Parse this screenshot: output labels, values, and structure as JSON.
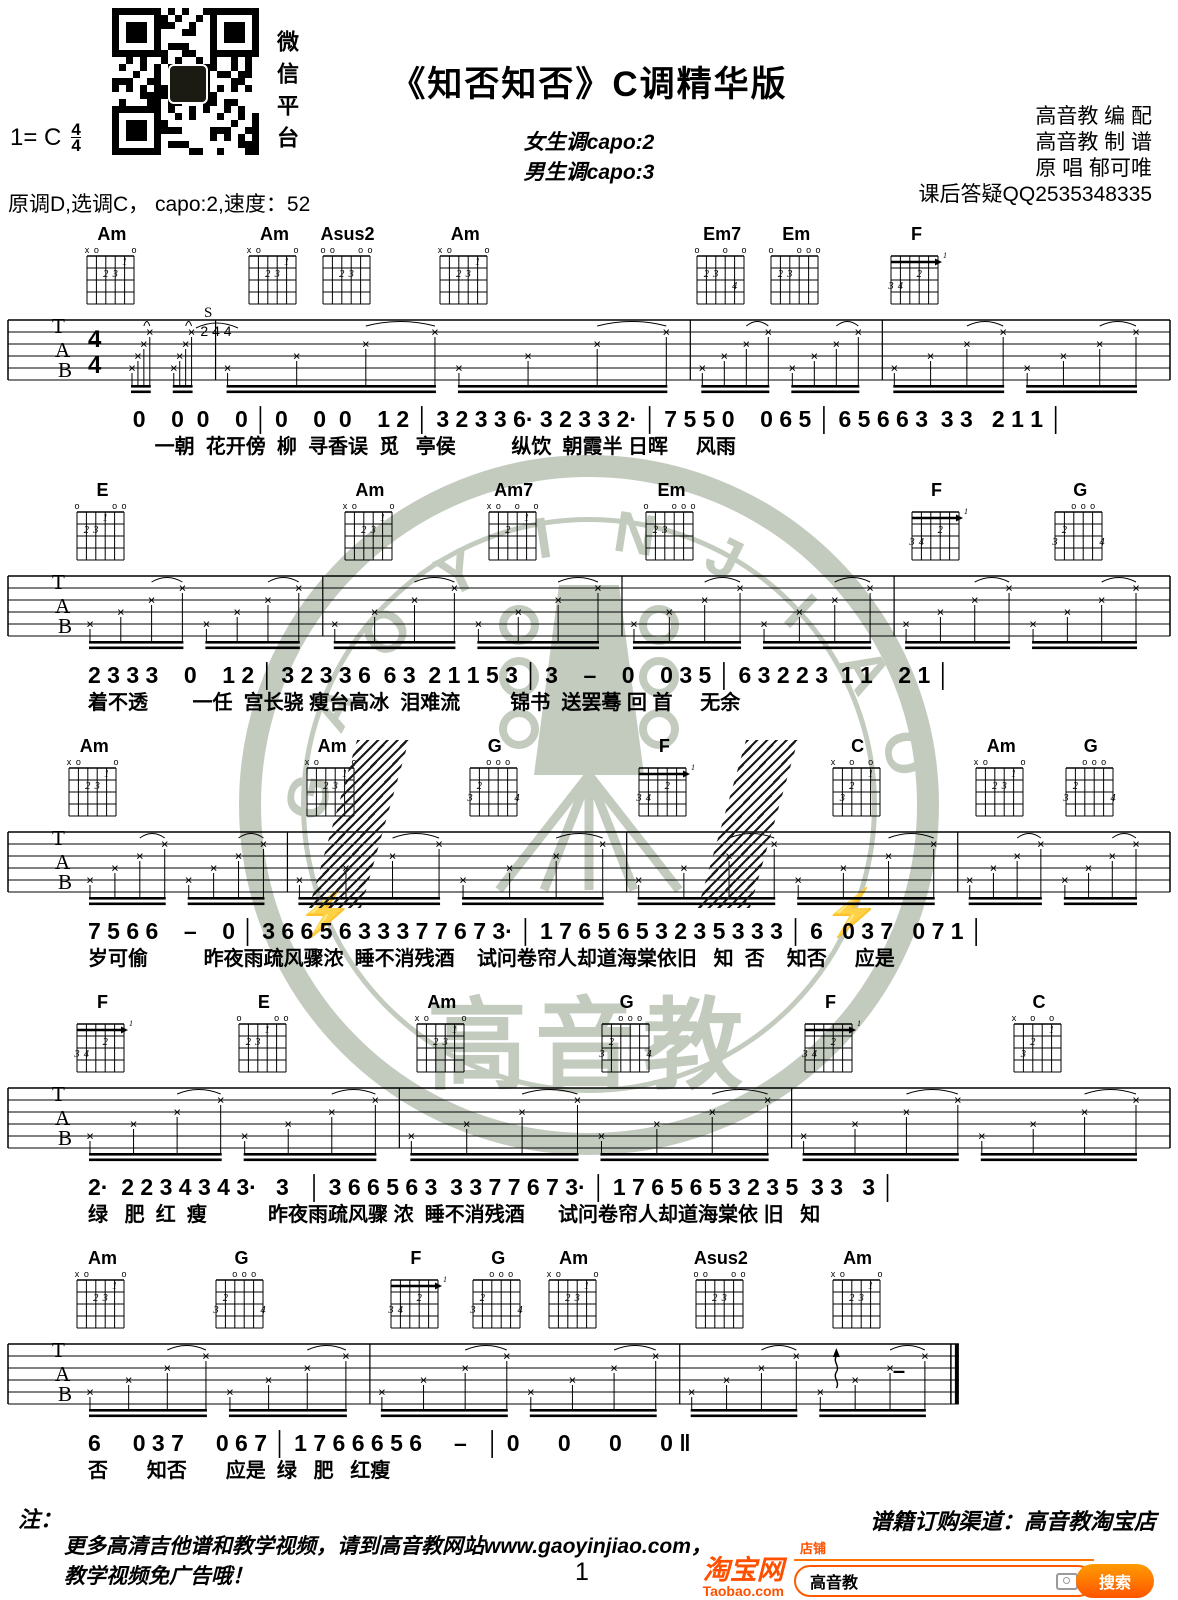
{
  "header": {
    "title": "《知否知否》C调精华版",
    "capo_female": "女生调capo:2",
    "capo_male": "男生调capo:3",
    "key": "1= C",
    "ts_top": "4",
    "ts_bottom": "4",
    "tempo_line": "原调D,选调C， capo:2,速度：52",
    "qr_caption": "微信平台",
    "credits": [
      "高音教 编  配",
      "高音教 制  谱",
      "原  唱  郁可唯",
      "课后答疑QQ2535348335"
    ]
  },
  "staff_letters": [
    "T",
    "A",
    "B"
  ],
  "chord_shapes": {
    "Am": {
      "markers": [
        "x",
        "o",
        "",
        "",
        "",
        "o"
      ],
      "dots": [
        [
          1,
          5,
          "1"
        ],
        [
          2,
          3,
          "2"
        ],
        [
          2,
          4,
          "3"
        ]
      ]
    },
    "Asus2": {
      "markers": [
        "o",
        "o",
        "",
        "",
        "o",
        "o"
      ],
      "dots": [
        [
          2,
          3,
          "2"
        ],
        [
          2,
          4,
          "3"
        ]
      ]
    },
    "Em7": {
      "markers": [
        "o",
        "",
        "",
        "o",
        "",
        "o"
      ],
      "dots": [
        [
          2,
          2,
          "2"
        ],
        [
          2,
          3,
          "3"
        ],
        [
          3,
          5,
          "4"
        ]
      ]
    },
    "Em": {
      "markers": [
        "o",
        "",
        "",
        "o",
        "o",
        "o"
      ],
      "dots": [
        [
          2,
          2,
          "2"
        ],
        [
          2,
          3,
          "3"
        ]
      ]
    },
    "F": {
      "markers": [
        "",
        "",
        "",
        "",
        "",
        ""
      ],
      "barre": {
        "fret": 1,
        "label": "1"
      },
      "dots": [
        [
          2,
          4,
          "2"
        ],
        [
          3,
          1,
          "3"
        ],
        [
          3,
          2,
          "4"
        ]
      ]
    },
    "E": {
      "markers": [
        "o",
        "",
        "",
        "",
        "o",
        "o"
      ],
      "dots": [
        [
          1,
          4,
          "1"
        ],
        [
          2,
          2,
          "2"
        ],
        [
          2,
          3,
          "3"
        ]
      ]
    },
    "Am7": {
      "markers": [
        "x",
        "o",
        "",
        "o",
        "",
        "o"
      ],
      "dots": [
        [
          1,
          5,
          "1"
        ],
        [
          2,
          3,
          "2"
        ]
      ]
    },
    "G": {
      "markers": [
        "",
        "",
        "o",
        "o",
        "o",
        ""
      ],
      "dots": [
        [
          2,
          2,
          "2"
        ],
        [
          3,
          1,
          "3"
        ],
        [
          3,
          6,
          "4"
        ]
      ]
    },
    "C": {
      "markers": [
        "x",
        "",
        "o",
        "",
        "o",
        ""
      ],
      "dots": [
        [
          1,
          5,
          "1"
        ],
        [
          2,
          3,
          "2"
        ],
        [
          3,
          2,
          "3"
        ]
      ]
    }
  },
  "systems": [
    {
      "chords": [
        {
          "name": "Am",
          "x": 9.5
        },
        {
          "name": "Am",
          "x": 23.3
        },
        {
          "name": "Asus2",
          "x": 29.5
        },
        {
          "name": "Am",
          "x": 39.5
        },
        {
          "name": "Em7",
          "x": 61.3
        },
        {
          "name": "Em",
          "x": 67.6
        },
        {
          "name": "F",
          "x": 77.8
        }
      ],
      "barlines": [
        18.3,
        58.6,
        74.9
      ],
      "show_time_sig": true,
      "annotation": "S",
      "annotation_nums": "2 4 4",
      "melody": "       0    0  0    0 │ 0    0  0    1 2 │ 3 2 3 3 6· 3 2 3 3 2· │ 7 5 5 0    0 6 5 │ 6 5 6 6 3  3 3   2 1 1 │",
      "lyrics": "            一朝  花开傍  柳  寻香误  觅   亭侯          纵饮  朝霞半 日晖     风雨"
    },
    {
      "chords": [
        {
          "name": "E",
          "x": 8.7
        },
        {
          "name": "Am",
          "x": 31.4
        },
        {
          "name": "Am7",
          "x": 43.6
        },
        {
          "name": "Em",
          "x": 57.0
        },
        {
          "name": "F",
          "x": 79.5
        },
        {
          "name": "G",
          "x": 91.7
        }
      ],
      "barlines": [
        27.4,
        52.8,
        75.9
      ],
      "melody": "2 3 3 3    0    1 2 │ 3 2 3 3 6  6 3  2 1 1 5 3 │ 3    –    0    0 3 5 │ 6 3 2 2 3  1 1    2 1 │",
      "lyrics": "着不透        一任  宫长骁 瘦台高冰  泪难流         锦书  送罢蓦 回 首     无余"
    },
    {
      "chords": [
        {
          "name": "Am",
          "x": 8.0
        },
        {
          "name": "Am",
          "x": 28.2
        },
        {
          "name": "G",
          "x": 42.0
        },
        {
          "name": "F",
          "x": 56.4
        },
        {
          "name": "C",
          "x": 72.8
        },
        {
          "name": "Am",
          "x": 85.0
        },
        {
          "name": "G",
          "x": 92.6
        }
      ],
      "barlines": [
        24.4,
        53.2,
        81.3
      ],
      "hatch": [
        30.5,
        63.5
      ],
      "melody": "7 5 6 6    –    0 │ 3 6 6 5 6 3 3 3 7 7 6 7 3· │ 1 7 6 5 6 5 3 2 3 5 3 3 3 │ 6   0 3 7   0 7 1 │",
      "lyrics": "岁可偷          昨夜雨疏风骤浓  睡不消残酒    试问卷帘人却道海棠依旧   知  否    知否     应是"
    },
    {
      "chords": [
        {
          "name": "F",
          "x": 8.7
        },
        {
          "name": "E",
          "x": 22.4
        },
        {
          "name": "Am",
          "x": 37.5
        },
        {
          "name": "G",
          "x": 53.2
        },
        {
          "name": "F",
          "x": 70.5
        },
        {
          "name": "C",
          "x": 88.2
        }
      ],
      "barlines": [
        33.9,
        67.2
      ],
      "melody": "2·  2 2 3 4 3 4 3·   3   │ 3 6 6 5 6 3  3 3 7 7 6 7 3· │ 1 7 6 5 6 5 3 2 3 5  3 3   3 │",
      "lyrics": "绿   肥  红  瘦           昨夜雨疏风骤 浓  睡不消残酒      试问卷帘人却道海棠依 旧   知"
    },
    {
      "chords": [
        {
          "name": "Am",
          "x": 8.7
        },
        {
          "name": "G",
          "x": 20.5
        },
        {
          "name": "F",
          "x": 35.3
        },
        {
          "name": "G",
          "x": 42.3
        },
        {
          "name": "Am",
          "x": 48.7
        },
        {
          "name": "Asus2",
          "x": 61.2
        },
        {
          "name": "Am",
          "x": 72.8
        }
      ],
      "barlines": [
        31.4,
        57.7
      ],
      "staff_end": 81.4,
      "end_double": true,
      "squiggle_x": 71.0,
      "dash_x": 75.8,
      "melody": "6     0 3 7     0 6 7 │ 1 7 6 6 6 5 6     –   │ 0      0      0      0 ‖",
      "lyrics": "否       知否       应是  绿   肥   红瘦"
    }
  ],
  "watermark": {
    "arc_text": "GAOYINJIAO",
    "cn_text": "高音教",
    "color": "#b9c2b4"
  },
  "footer": {
    "note_label": "注：",
    "note_line1": "更多高清吉他谱和教学视频，请到高音教网站www.gaoyinjiao.com，",
    "note_line2": "教学视频免广告哦！",
    "page": "1",
    "slogan": "谱籍订购渠道：高音教淘宝店"
  },
  "taobao": {
    "logo_cn": "淘宝网",
    "logo_en": "Taobao.com",
    "tab": "店铺",
    "query": "高音教",
    "search": "搜索"
  }
}
